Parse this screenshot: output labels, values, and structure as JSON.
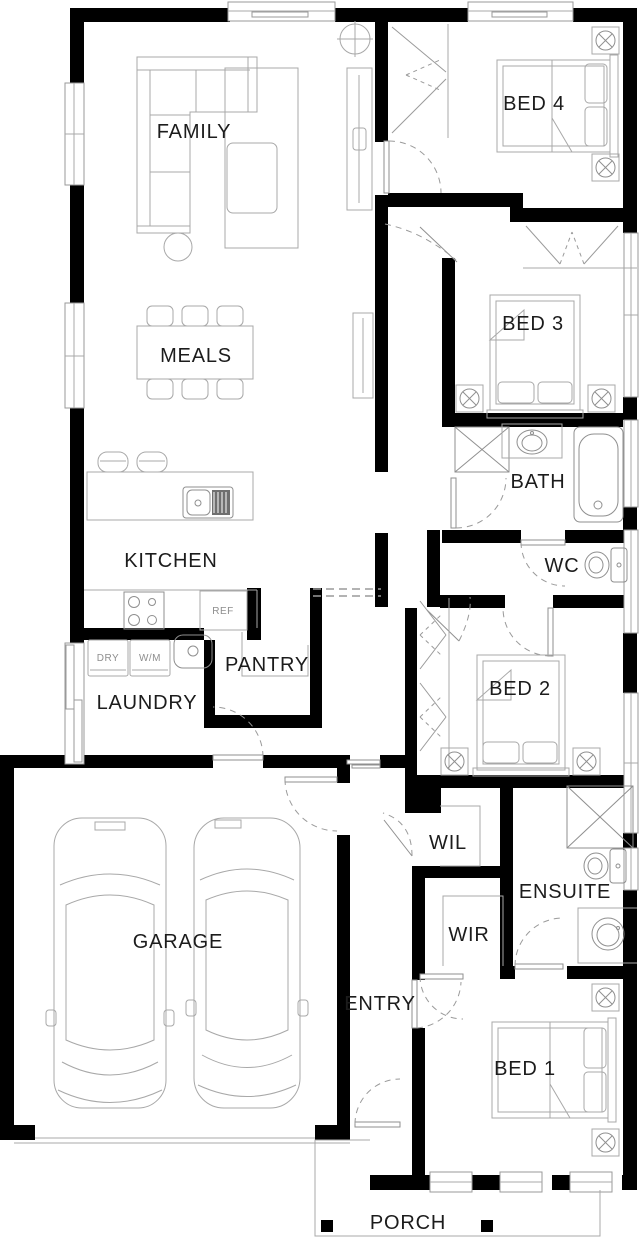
{
  "plan": {
    "rooms": [
      {
        "label": "FAMILY"
      },
      {
        "label": "MEALS"
      },
      {
        "label": "KITCHEN"
      },
      {
        "label": "PANTRY"
      },
      {
        "label": "LAUNDRY"
      },
      {
        "label": "GARAGE"
      },
      {
        "label": "ENTRY"
      },
      {
        "label": "PORCH"
      },
      {
        "label": "BED 4"
      },
      {
        "label": "BED 3"
      },
      {
        "label": "BATH"
      },
      {
        "label": "WC"
      },
      {
        "label": "BED 2"
      },
      {
        "label": "WIL"
      },
      {
        "label": "ENSUITE"
      },
      {
        "label": "WIR"
      },
      {
        "label": "BED 1"
      }
    ],
    "appliances": [
      {
        "label": "REF"
      },
      {
        "label": "DRY"
      },
      {
        "label": "W/M"
      }
    ],
    "colors": {
      "wall": "#000000",
      "furniture_line": "#a8a8a8",
      "label_text": "#1c1c1c",
      "background": "#ffffff"
    }
  }
}
